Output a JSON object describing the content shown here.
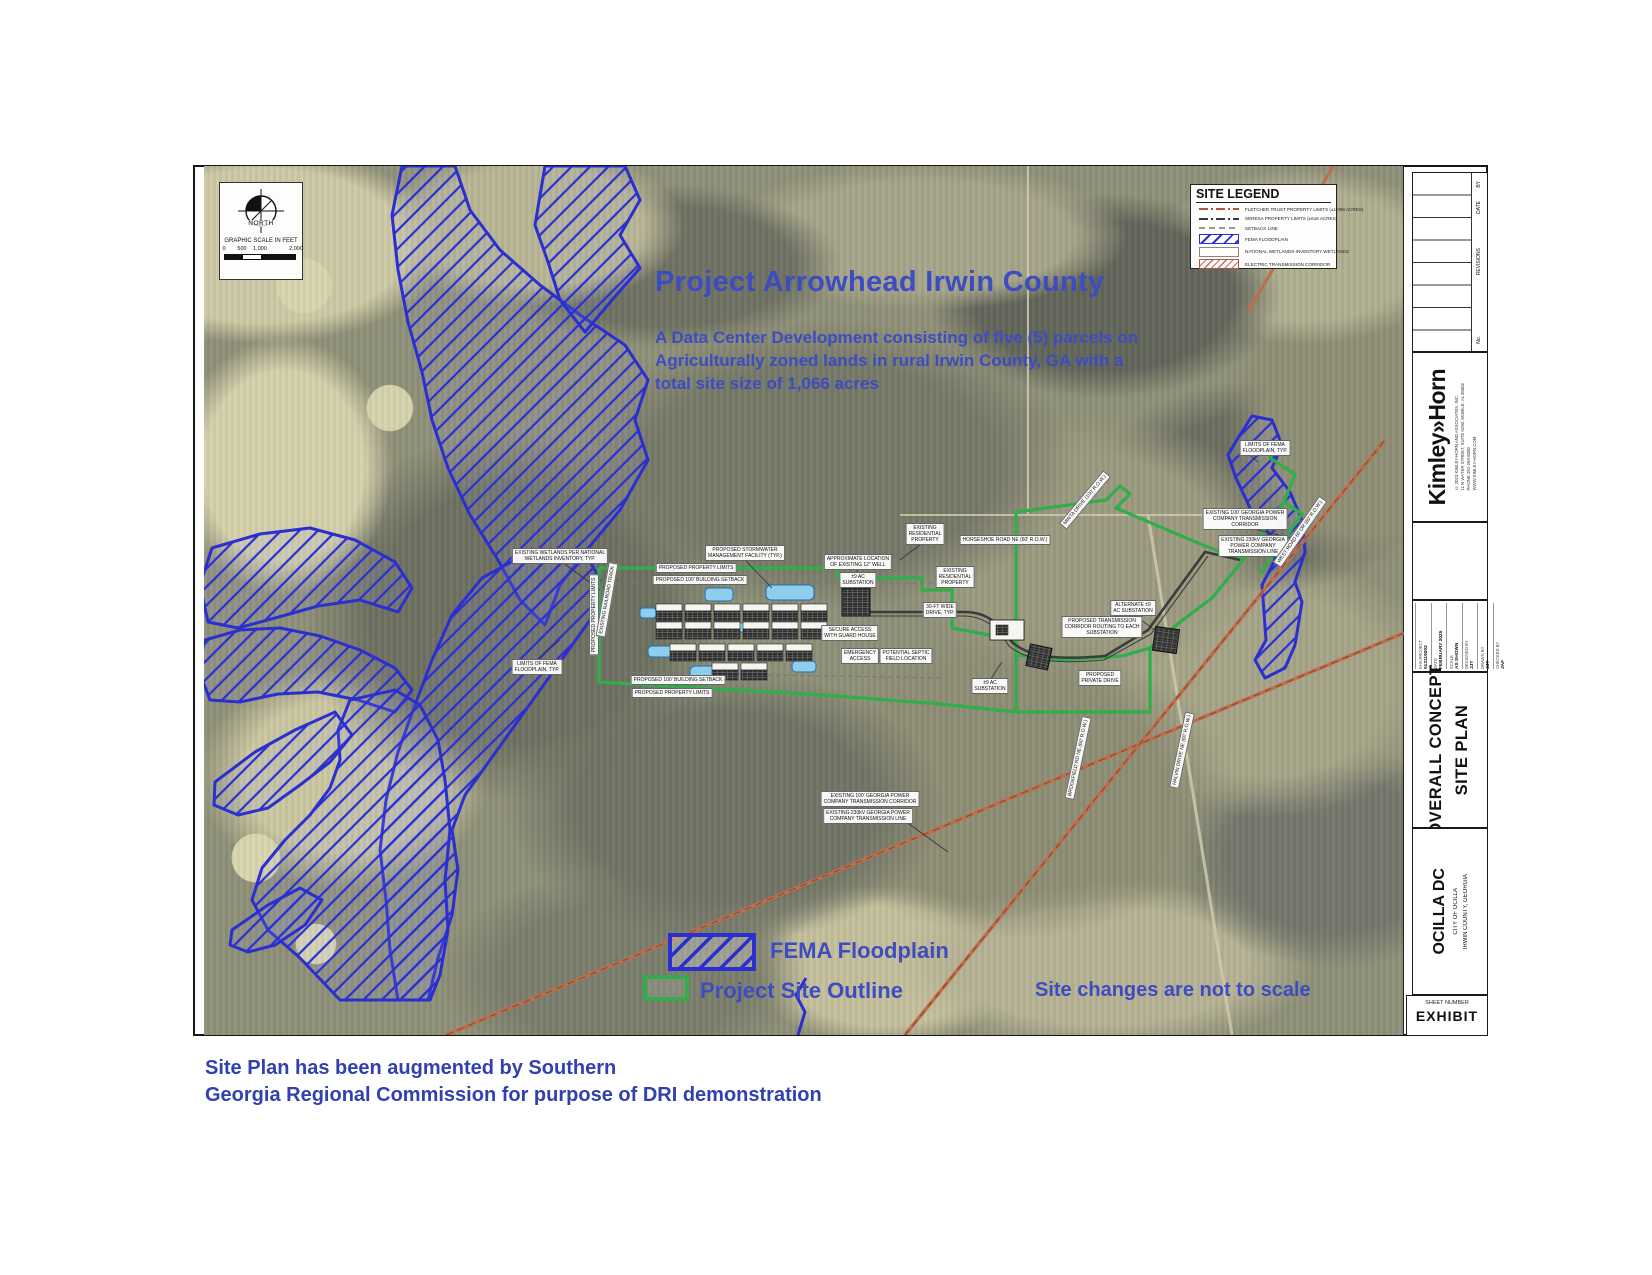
{
  "page": {
    "title": "Project Arrowhead Irwin County",
    "subtitle_lines": [
      "A Data Center Development consisting of five (5) parcels on",
      "Agriculturally zoned lands in rural Irwin County, GA with a",
      "total site size of 1,066 acres"
    ],
    "note": "Site changes are not to scale",
    "footer_line1": "Site Plan has been augmented by Southern",
    "footer_line2": "Georgia Regional Commission for purpose of DRI demonstration"
  },
  "colors": {
    "accent_blue": "#3d4cc0",
    "floodplain_blue": "#2b2fd0",
    "site_green": "#2fae4a",
    "corridor_orange": "#b86a48"
  },
  "north": {
    "label": "NORTH",
    "scale_title": "GRAPHIC SCALE IN FEET",
    "scale_ticks": [
      "0",
      "500",
      "1,000",
      "2,000"
    ]
  },
  "site_legend": {
    "title": "SITE LEGEND",
    "rows": [
      {
        "symbol": "sw-line sw-red",
        "tall": false,
        "text": "FLETCHER TRUST PROPERTY LIMITS (±1,066 ACRES)"
      },
      {
        "symbol": "sw-line sw-navy",
        "tall": false,
        "text": "SERESA PROPERTY LIMITS (±616 ACRES)"
      },
      {
        "symbol": "sw-line sw-gray",
        "tall": false,
        "text": "SETBACK LINE"
      },
      {
        "symbol": "sw-box sw-fema",
        "tall": true,
        "text": "FEMA FLOODPLAIN"
      },
      {
        "symbol": "sw-box sw-plain",
        "tall": true,
        "text": "NATIONAL WETLANDS INVENTORY WETLANDS"
      },
      {
        "symbol": "sw-box sw-etc",
        "tall": true,
        "text": "ELECTRIC TRANSMISSION CORRIDOR"
      }
    ]
  },
  "map_legend": {
    "fema": "FEMA Floodplain",
    "site": "Project Site Outline"
  },
  "map": {
    "labels": [
      {
        "t": "EXISTING WETLANDS PER NATIONAL\nWETLANDS INVENTORY, TYP.",
        "x": 560,
        "y": 556
      },
      {
        "t": "PROPOSED STORMWATER\nMANAGEMENT FACILITY (TYP.)",
        "x": 745,
        "y": 553
      },
      {
        "t": "APPROXIMATE LOCATION\nOF EXISTING 12\" WELL",
        "x": 858,
        "y": 562
      },
      {
        "t": "EXISTING\nRESIDENTIAL\nPROPERTY",
        "x": 925,
        "y": 534
      },
      {
        "t": "HORSESHOE ROAD NE (60' R.O.W.)",
        "x": 1005,
        "y": 540
      },
      {
        "t": "±9 AC\nSUBSTATION",
        "x": 858,
        "y": 580
      },
      {
        "t": "EXISTING\nRESIDENTIAL\nPROPERTY",
        "x": 955,
        "y": 577
      },
      {
        "t": "30-FT WIDE\nDRIVE, TYP.",
        "x": 940,
        "y": 610
      },
      {
        "t": "SECURE ACCESS\nWITH GUARD HOUSE",
        "x": 850,
        "y": 633
      },
      {
        "t": "EMERGENCY\nACCESS",
        "x": 860,
        "y": 656
      },
      {
        "t": "POTENTIAL SEPTIC\nFIELD LOCATION",
        "x": 906,
        "y": 656
      },
      {
        "t": "ALTERNATE ±9\nAC SUBSTATION",
        "x": 1133,
        "y": 608
      },
      {
        "t": "PROPOSED TRANSMISSION\nCORRIDOR ROUTING TO EACH\nSUBSTATION",
        "x": 1102,
        "y": 627
      },
      {
        "t": "±9 AC\nSUBSTATION",
        "x": 990,
        "y": 686
      },
      {
        "t": "PROPOSED PROPERTY LIMITS",
        "x": 696,
        "y": 568
      },
      {
        "t": "PROPOSED 100' BUILDING SETBACK",
        "x": 700,
        "y": 580
      },
      {
        "t": "PROPOSED 100' BUILDING SETBACK",
        "x": 678,
        "y": 680
      },
      {
        "t": "PROPOSED PROPERTY LIMITS",
        "x": 672,
        "y": 693
      },
      {
        "t": "LIMITS OF FEMA\nFLOODPLAIN, TYP.",
        "x": 537,
        "y": 667
      },
      {
        "t": "LIMITS OF FEMA\nFLOODPLAIN, TYP.",
        "x": 1265,
        "y": 448
      },
      {
        "t": "EXISTING 100' GEORGIA POWER\nCOMPANY TRANSMISSION\nCORRIDOR",
        "x": 1245,
        "y": 519
      },
      {
        "t": "EXISTING 230kV GEORGIA\nPOWER COMPANY\nTRANSMISSION LINE",
        "x": 1253,
        "y": 546
      },
      {
        "t": "EXISTING 100' GEORGIA POWER\nCOMPANY TRANSMISSION CORRIDOR",
        "x": 870,
        "y": 799
      },
      {
        "t": "EXISTING 230kV GEORGIA POWER\nCOMPANY TRANSMISSION LINE",
        "x": 868,
        "y": 816
      },
      {
        "t": "PROPOSED\nPRIVATE DRIVE",
        "x": 1100,
        "y": 678
      },
      {
        "t": "PROPOSED PROPERTY LIMITS",
        "x": 594,
        "y": 615,
        "r": -90
      },
      {
        "t": "EXISTING RAILROAD TRACK",
        "x": 607,
        "y": 600,
        "r": -80
      },
      {
        "t": "MINTA DRIVE (100' R.O.W.)",
        "x": 1085,
        "y": 500,
        "r": -50
      },
      {
        "t": "WEST ROAD 60 DR (60' R.O.W.)",
        "x": 1300,
        "y": 532,
        "r": -55
      },
      {
        "t": "HALVIN DRIVE NE (60' R.O.W.)",
        "x": 1182,
        "y": 750,
        "r": -78
      },
      {
        "t": "BROOKFIELD RD NE (60' R.O.W.)",
        "x": 1078,
        "y": 758,
        "r": -78
      }
    ]
  },
  "titleblock": {
    "revisions": {
      "no": "No.",
      "label": "REVISIONS",
      "date": "DATE",
      "by": "BY"
    },
    "logo": "Kimley»Horn",
    "logo_sub": [
      "© 2023 KIMLEY-HORN AND ASSOCIATES, INC.",
      "11 N WATER STREET, SUITE 9250, MOBILE, AL 36602",
      "PHONE 251-263-8350",
      "WWW.KIMLEY-HORN.COM"
    ],
    "project_rows": [
      [
        "KHA PROJECT",
        "013119202"
      ],
      [
        "DATE",
        "FEBRUARY 2025"
      ],
      [
        "SCALE",
        "AS SHOWN"
      ],
      [
        "DESIGNED BY",
        "JJT"
      ],
      [
        "DRAWN BY",
        "JJT"
      ],
      [
        "CHECKED BY",
        "JAF"
      ]
    ],
    "sheet_title_line1": "OVERALL CONCEPT",
    "sheet_title_line2": "SITE  PLAN",
    "project_name": "OCILLA DC",
    "client_line1": "CITY OF OCILLA",
    "client_line2": "IRWIN COUNTY, GEORGIA",
    "sheet_number_label": "SHEET NUMBER",
    "sheet_number": "EXHIBIT"
  }
}
